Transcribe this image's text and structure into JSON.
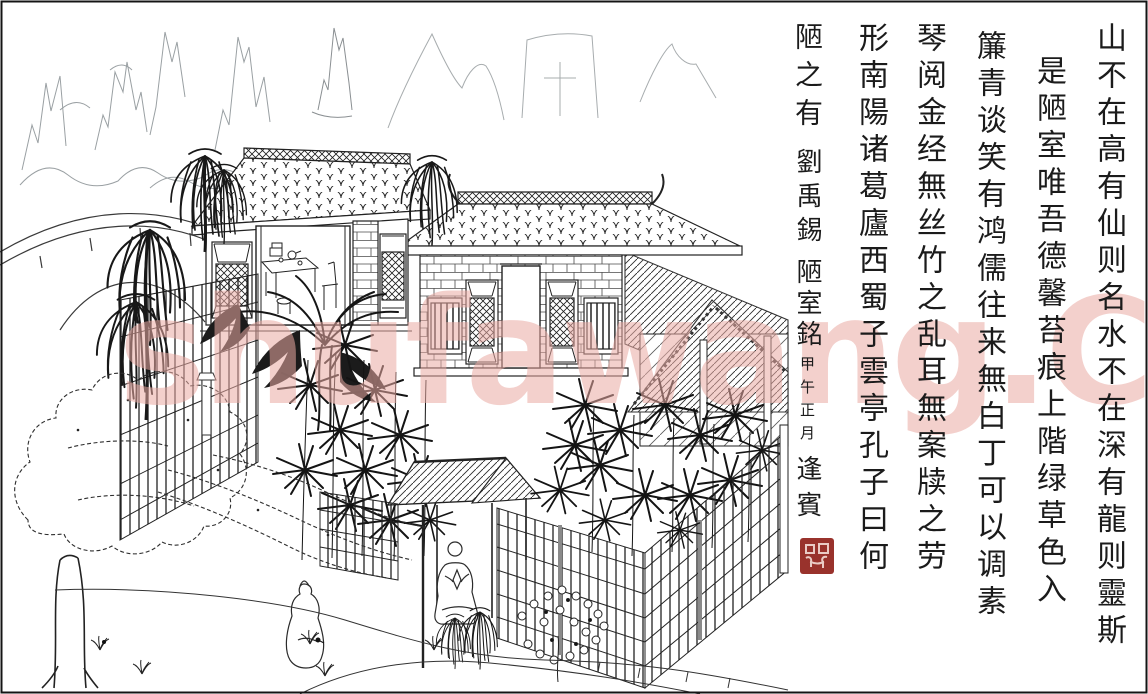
{
  "artwork": {
    "poem_title": "陋室銘",
    "columns": [
      "山不在高有仙则名水不在深有龍则靈斯",
      "是陋室唯吾德馨苔痕上階绿草色入",
      "簾青谈笑有鸿儒往来無白丁可以调素",
      "琴阅金经無丝竹之乱耳無案牍之劳",
      "形南陽诸葛廬西蜀子雲亭孔子曰何",
      "陋之有"
    ],
    "signature": {
      "author": "劉禹錫",
      "title": "陋室銘",
      "date": "甲午正月",
      "calligrapher": "逢賓"
    },
    "seal_color": "#99322c"
  },
  "watermark": {
    "text": "shufawang.CN",
    "color": "#eaaaa3"
  },
  "colors": {
    "ink": "#1f1f1f",
    "faint_mountain": "#9aa0a3",
    "paper": "#ffffff",
    "seal_red": "#99322c",
    "watermark_pink": "#eaaaa3"
  }
}
